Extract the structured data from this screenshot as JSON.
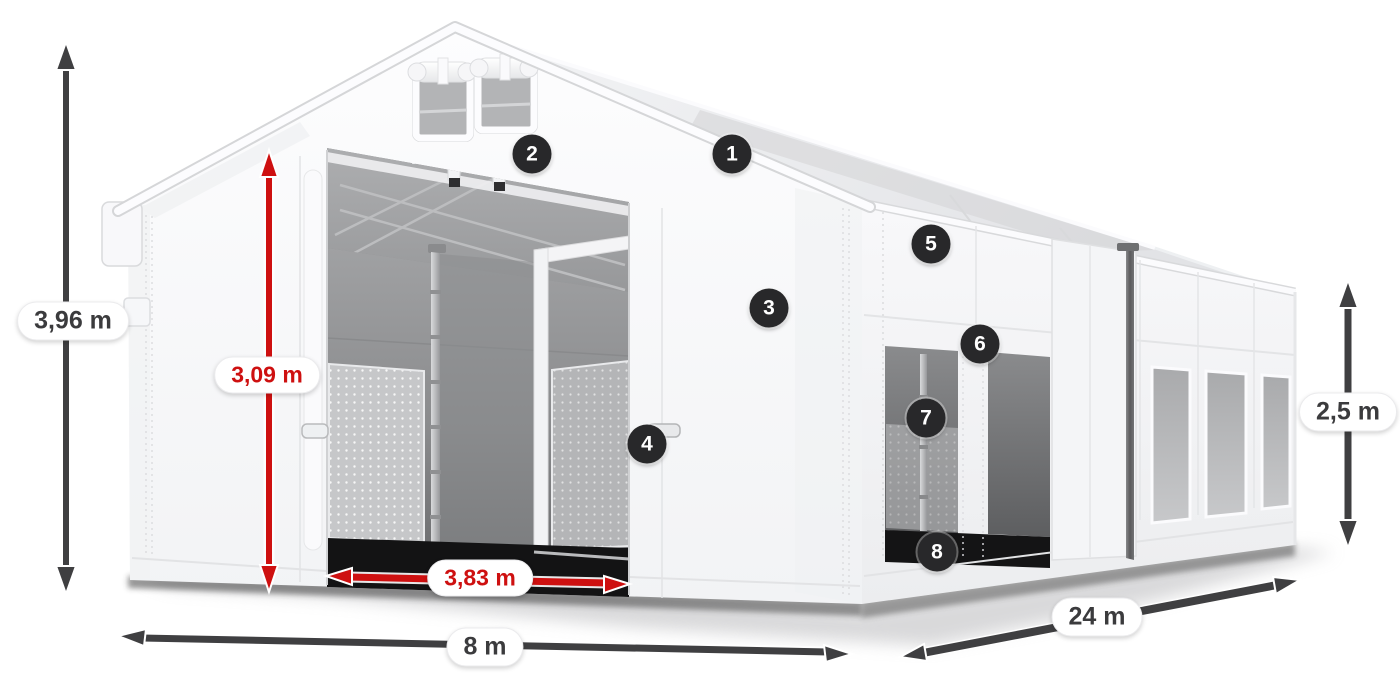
{
  "colors": {
    "accent_red": "#ce1010",
    "arrow_dark": "#3f3f41",
    "badge_background": "#28282a",
    "badge_text": "#ffffff",
    "label_background": "#ffffff",
    "label_text_dark": "#3b3b3d",
    "tent_white": "#f8f8fa",
    "interior_gray": "#8e8f91",
    "background": "#ffffff"
  },
  "dimensions": {
    "total_height": {
      "value": "3,96 m",
      "color": "dark",
      "arrow": "vertical-double"
    },
    "entrance_height": {
      "value": "3,09 m",
      "color": "red",
      "arrow": "vertical-double"
    },
    "entrance_width": {
      "value": "3,83 m",
      "color": "red",
      "arrow": "horizontal-double"
    },
    "front_width": {
      "value": "8 m",
      "color": "dark",
      "arrow": "horizontal-double"
    },
    "side_length": {
      "value": "24 m",
      "color": "dark",
      "arrow": "diagonal-double"
    },
    "side_wall_height": {
      "value": "2,5 m",
      "color": "dark",
      "arrow": "vertical-double"
    }
  },
  "callouts": [
    "1",
    "2",
    "3",
    "4",
    "5",
    "6",
    "7",
    "8"
  ]
}
